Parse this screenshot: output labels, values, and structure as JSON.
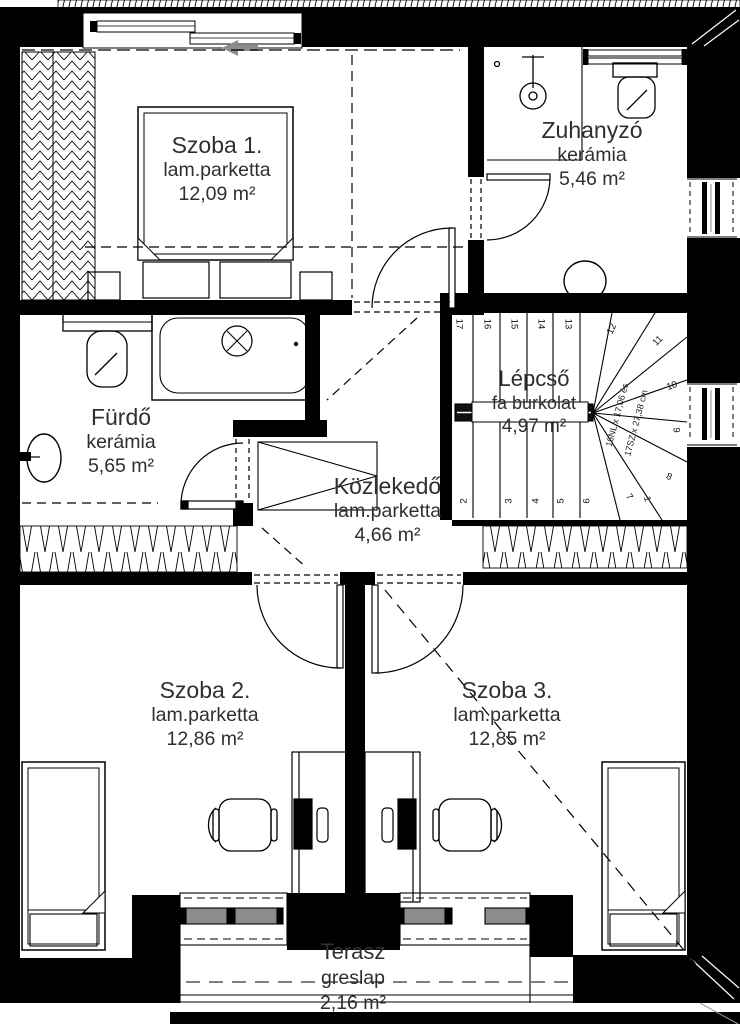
{
  "rooms": {
    "szoba1": {
      "name": "Szoba 1.",
      "material": "lam.parketta",
      "area": "12,09 m²"
    },
    "zuhanyzo": {
      "name": "Zuhanyzó",
      "material": "kerámia",
      "area": "5,46 m²"
    },
    "furdo": {
      "name": "Fürdő",
      "material": "kerámia",
      "area": "5,65 m²"
    },
    "lepcso": {
      "name": "Lépcső",
      "material": "fa burkolat",
      "area": "4,97 m²"
    },
    "kozlekedo": {
      "name": "Közlekedő",
      "material": "lam.parketta",
      "area": "4,66 m²"
    },
    "szoba2": {
      "name": "Szoba 2.",
      "material": "lam.parketta",
      "area": "12,86 m²"
    },
    "szoba3": {
      "name": "Szoba 3.",
      "material": "lam.parketta",
      "area": "12,85 m²"
    },
    "terasz": {
      "name": "Terasz",
      "material": "greslap",
      "area": "2,16 m²"
    }
  },
  "stairs": {
    "steps": [
      "1",
      "2",
      "3",
      "4",
      "5",
      "6",
      "7",
      "8",
      "9",
      "10",
      "11",
      "12",
      "13",
      "14",
      "15",
      "16",
      "17"
    ],
    "note_line1": "16NL x 17,06 és",
    "note_line2": "17SZ x 27,38 cm"
  },
  "colors": {
    "wall": "#000000",
    "pane_gray": "#8c8c8c",
    "text": "#2f2f2f"
  }
}
